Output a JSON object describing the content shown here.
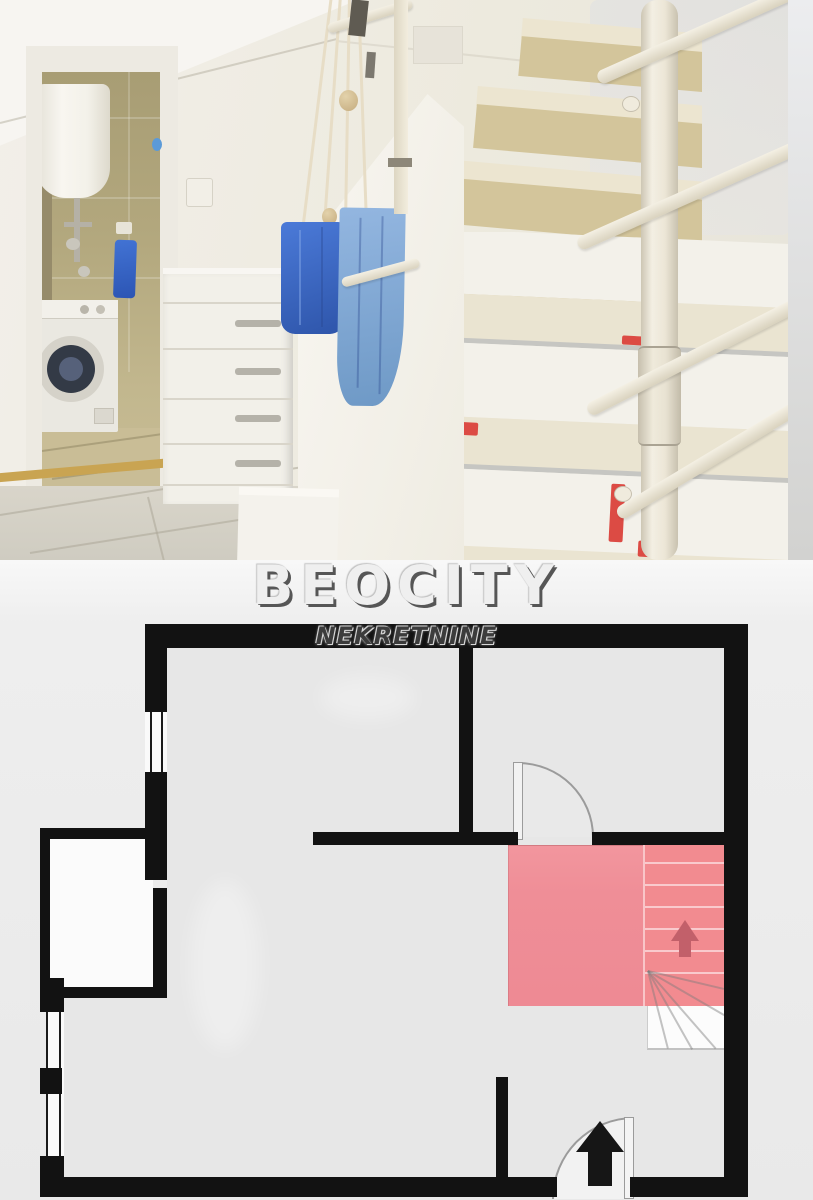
{
  "watermark": {
    "brand": "BEOCITY",
    "subtitle": "NEKRETNINE",
    "brand_color": "#efefef",
    "brand_shadow_color": "#565656",
    "subtitle_color": "#3c3c3c"
  },
  "photo": {
    "scene": "hallway with white staircase, open bathroom door with washing machine and water heater, white dresser with hanging blue bags",
    "colors": {
      "wall_cream": "#f0ece4",
      "bathroom_tile": "#b3a87e",
      "boiler_white": "#f5f3ec",
      "washer_body": "#eae8e1",
      "washer_door": "#333a46",
      "towel_blue": "#2f62c8",
      "bag_blue_dark": "#3a66c4",
      "bag_blue_light": "#7fa9d4",
      "dresser_white": "#f2f0e9",
      "stair_tread_cream": "#ece5d0",
      "stair_riser_tan": "#d3c59b",
      "big_step_white": "#f3f1ea",
      "red_tape": "#dc4b44",
      "pole_cream": "#ece6d6",
      "floor_gray": "#d9d5ca"
    }
  },
  "floor_plan": {
    "wall_color": "#121212",
    "room_fill": "#e7e7e7",
    "balcony_fill": "#fbfbfb",
    "door_line_color": "#9b9b9b",
    "window_count": 2,
    "door_count": 2,
    "staircase": {
      "landing_fill": "#f0929b",
      "treads_fill": "#f28b90",
      "tread_count": 6,
      "winder_fill": "#fcfcfc",
      "arrow_color": "#c2606a",
      "direction": "up"
    },
    "entrance": {
      "arrow_color": "#161616",
      "direction": "up"
    }
  }
}
